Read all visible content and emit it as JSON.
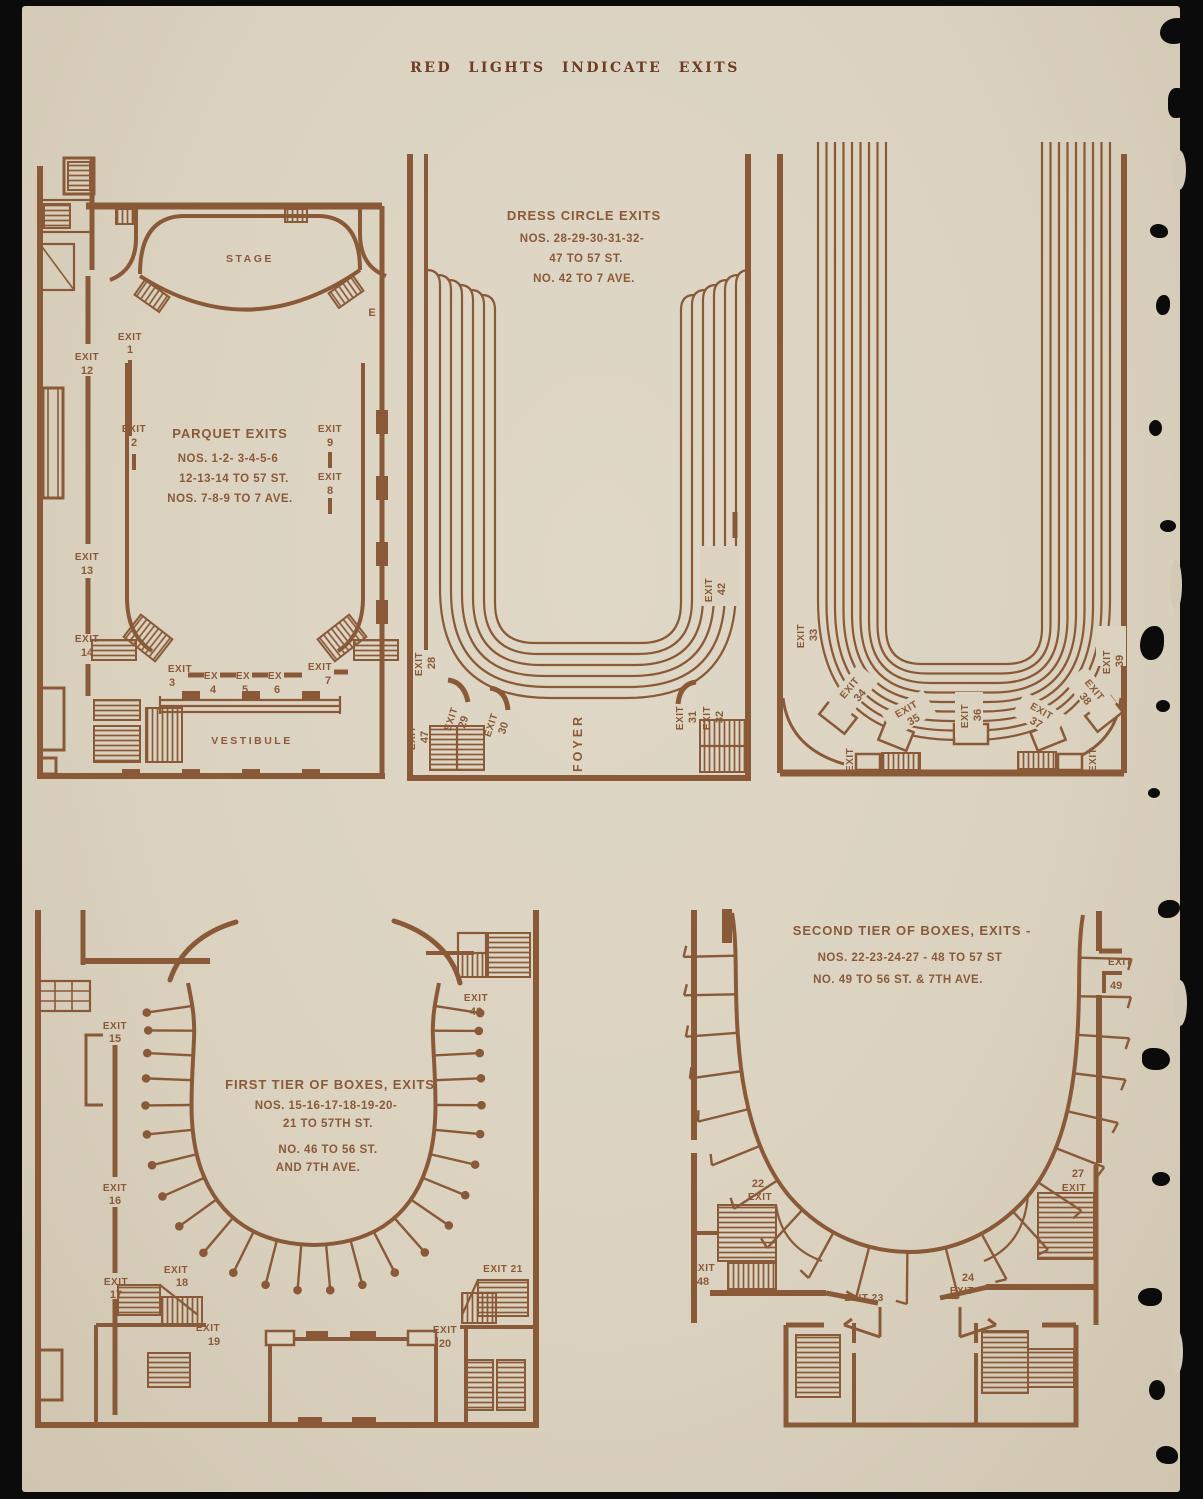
{
  "header": {
    "title": "RED LIGHTS INDICATE EXITS"
  },
  "colors": {
    "ink": "#8a5a38",
    "ink_dark": "#6f3c22",
    "paper": "#dbd2c0",
    "background": "#0b0b0b"
  },
  "parquet": {
    "stage": "STAGE",
    "vestibule": "VESTIBULE",
    "e_label": "E",
    "info": [
      "PARQUET EXITS",
      "NOS. 1-2- 3-4-5-6",
      "12-13-14 TO 57 ST.",
      "NOS. 7-8-9 TO 7 AVE."
    ],
    "exits": {
      "e1": {
        "w": "EXIT",
        "n": "1"
      },
      "e2": {
        "w": "EXIT",
        "n": "2"
      },
      "e3": {
        "w": "EXIT",
        "n": "3"
      },
      "e4": {
        "w": "EX",
        "n": "4"
      },
      "e5": {
        "w": "EX",
        "n": "5"
      },
      "e6": {
        "w": "EX",
        "n": "6"
      },
      "e7": {
        "w": "EXIT",
        "n": "7"
      },
      "e8": {
        "w": "EXIT",
        "n": "8"
      },
      "e9": {
        "w": "EXIT",
        "n": "9"
      },
      "e12": {
        "w": "EXIT",
        "n": "12"
      },
      "e13": {
        "w": "EXIT",
        "n": "13"
      },
      "e14": {
        "w": "EXIT",
        "n": "14"
      }
    }
  },
  "dress_circle": {
    "info": [
      "DRESS CIRCLE EXITS",
      "NOS. 28-29-30-31-32-",
      "47 TO 57 ST.",
      "NO. 42 TO 7 AVE."
    ],
    "foyer": "FOYER",
    "exits": {
      "e28": {
        "w": "EXIT",
        "n": "28"
      },
      "e29": {
        "w": "EXIT",
        "n": "29"
      },
      "e30": {
        "w": "EXIT",
        "n": "30"
      },
      "e31": {
        "w": "EXIT",
        "n": "31"
      },
      "e32": {
        "w": "EXIT",
        "n": "32"
      },
      "e42": {
        "w": "EXIT",
        "n": "42"
      },
      "e47": {
        "w": "EXIT",
        "n": "47"
      }
    }
  },
  "balcony": {
    "corner_left": "EXIT",
    "corner_right": "EXIT",
    "exits": {
      "e33": {
        "w": "EXIT",
        "n": "33"
      },
      "e34": {
        "w": "EXIT",
        "n": "34"
      },
      "e35": {
        "w": "EXIT",
        "n": "35"
      },
      "e36": {
        "w": "EXIT",
        "n": "36"
      },
      "e37": {
        "w": "EXIT",
        "n": "37"
      },
      "e38": {
        "w": "EXIT",
        "n": "38"
      },
      "e39": {
        "w": "EXIT",
        "n": "39"
      }
    }
  },
  "first_tier": {
    "info": [
      "FIRST TIER OF BOXES, EXITS",
      "NOS. 15-16-17-18-19-20-",
      "21 TO 57TH ST.",
      "NO. 46 TO 56 ST.",
      "AND 7TH AVE."
    ],
    "e21": "EXIT 21",
    "exits": {
      "e15": {
        "w": "EXIT",
        "n": "15"
      },
      "e16": {
        "w": "EXIT",
        "n": "16"
      },
      "e17": {
        "w": "EXIT",
        "n": "17"
      },
      "e18": {
        "w": "EXIT",
        "n": "18"
      },
      "e19": {
        "w": "EXIT",
        "n": "19"
      },
      "e20": {
        "w": "EXIT",
        "n": "20"
      },
      "e46": {
        "w": "EXIT",
        "n": "46"
      }
    }
  },
  "second_tier": {
    "info": [
      "SECOND TIER OF BOXES, EXITS -",
      "NOS. 22-23-24-27 - 48 TO 57 ST",
      "NO. 49 TO 56 ST. & 7TH AVE."
    ],
    "e23": "EXIT 23",
    "exits": {
      "e22": {
        "n": "22",
        "w": "EXIT"
      },
      "e24": {
        "n": "24",
        "w": "EXIT"
      },
      "e27": {
        "n": "27",
        "w": "EXIT"
      },
      "e48": {
        "w": "EXIT",
        "n": "48"
      },
      "e49": {
        "w": "EXIT",
        "n": "49"
      }
    }
  }
}
